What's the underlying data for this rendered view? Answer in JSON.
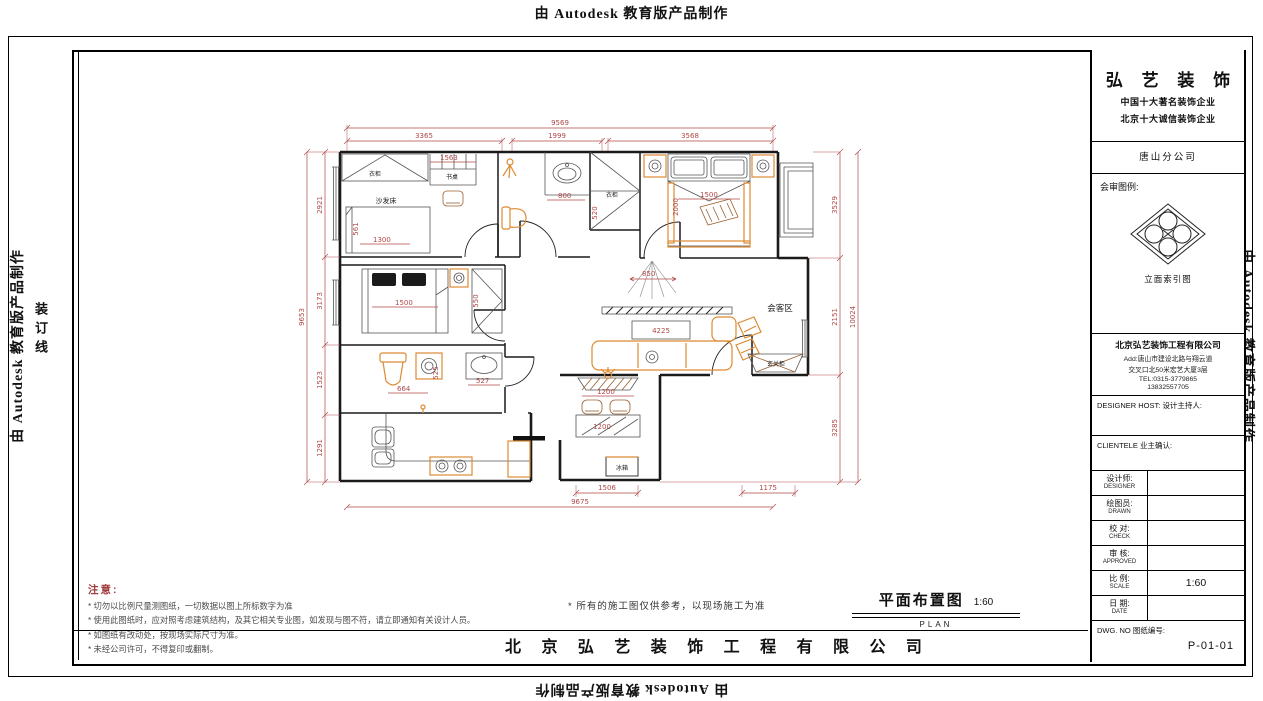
{
  "colors": {
    "dimension": "#b04848",
    "furniture_accent": "#dd8a33",
    "wall": "#1a1a1a",
    "note_title": "#a03c3c"
  },
  "watermarks": {
    "top": "由 Autodesk 教育版产品制作",
    "bottom": "由 Autodesk 教育版产品制作",
    "left": "由 Autodesk 教育版产品制作",
    "right": "由 Autodesk 教育版产品制作",
    "binding_line": "装订线"
  },
  "title_block": {
    "brand": "弘 艺 装 饰",
    "slogan1": "中国十大著名装饰企业",
    "slogan2": "北京十大诚信装饰企业",
    "branch": "唐山分公司",
    "legend_label": "会审图例:",
    "logo_caption": "立面索引图",
    "company_full": "北京弘艺装饰工程有限公司",
    "address1": "Add:唐山市建设北路与翔云道",
    "address2": "交叉口北50米宏艺大厦3层",
    "tel": "TEL:0315-3779865",
    "mobile": "13832557705",
    "designer_host_en": "DESIGNER HOST:",
    "designer_host_cn": "设计主持人:",
    "client_en": "CLIENTELE",
    "client_cn": "业主确认:",
    "rows": [
      {
        "cn": "设计师:",
        "en": "DESIGNER",
        "value": ""
      },
      {
        "cn": "绘图员:",
        "en": "DRAWN",
        "value": ""
      },
      {
        "cn": "校  对:",
        "en": "CHECK",
        "value": ""
      },
      {
        "cn": "审  核:",
        "en": "APPROVED",
        "value": ""
      },
      {
        "cn": "比  例:",
        "en": "SCALE",
        "value": "1:60"
      },
      {
        "cn": "日  期:",
        "en": "DATE",
        "value": ""
      }
    ],
    "dwg_label": "DWG. NO  图纸编号:",
    "dwg_no": "P-01-01"
  },
  "notes": {
    "title": "注意:",
    "items": [
      "* 切勿以比例尺量测图纸，一切数据以图上所标数字为准",
      "* 使用此图纸时，应对照考虑建筑结构，及其它相关专业图，如发现与图不符，请立即通知有关设计人员。",
      "* 如图纸有改动处，按现场实际尺寸为准。",
      "* 未经公司许可，不得复印或翻制。"
    ],
    "reference": "* 所有的施工图仅供参考，以现场施工为准"
  },
  "footer": {
    "drawing_title": "平面布置图",
    "drawing_scale": "1:60",
    "drawing_title_en": "PLAN",
    "company": "北 京 弘 艺 装 饰 工 程 有 限 公 司"
  },
  "floor_plan": {
    "labels": {
      "wardrobe1": "衣柜",
      "desk": "书桌",
      "sofa_bed": "沙发床",
      "wardrobe2": "衣柜",
      "living": "会客区",
      "entry_cabinet": "玄关柜",
      "fridge": "冰箱"
    },
    "dims": {
      "top_total": "9569",
      "top_1": "3365",
      "top_2": "1999",
      "top_3": "3568",
      "left_total": "9653",
      "left_1": "2921",
      "left_2": "3173",
      "left_3": "1523",
      "left_4": "1291",
      "right_total": "10024",
      "right_1": "3529",
      "right_2": "2151",
      "right_3": "3285",
      "bottom_total": "9675",
      "bottom_1": "1506",
      "bottom_2": "1175",
      "desk": "1563",
      "bath1_sink": "800",
      "bed1_w": "1300",
      "bed1_h": "561",
      "ward2_d": "520",
      "master_bed_w": "1500",
      "master_bed_l": "2000",
      "hall_open": "850",
      "sofa": "4225",
      "cabinet": "1200",
      "table": "1200",
      "bath2_sink": "527",
      "bath2": "664",
      "bath2_d": "525",
      "bed2": "1500",
      "ward3": "550"
    }
  }
}
